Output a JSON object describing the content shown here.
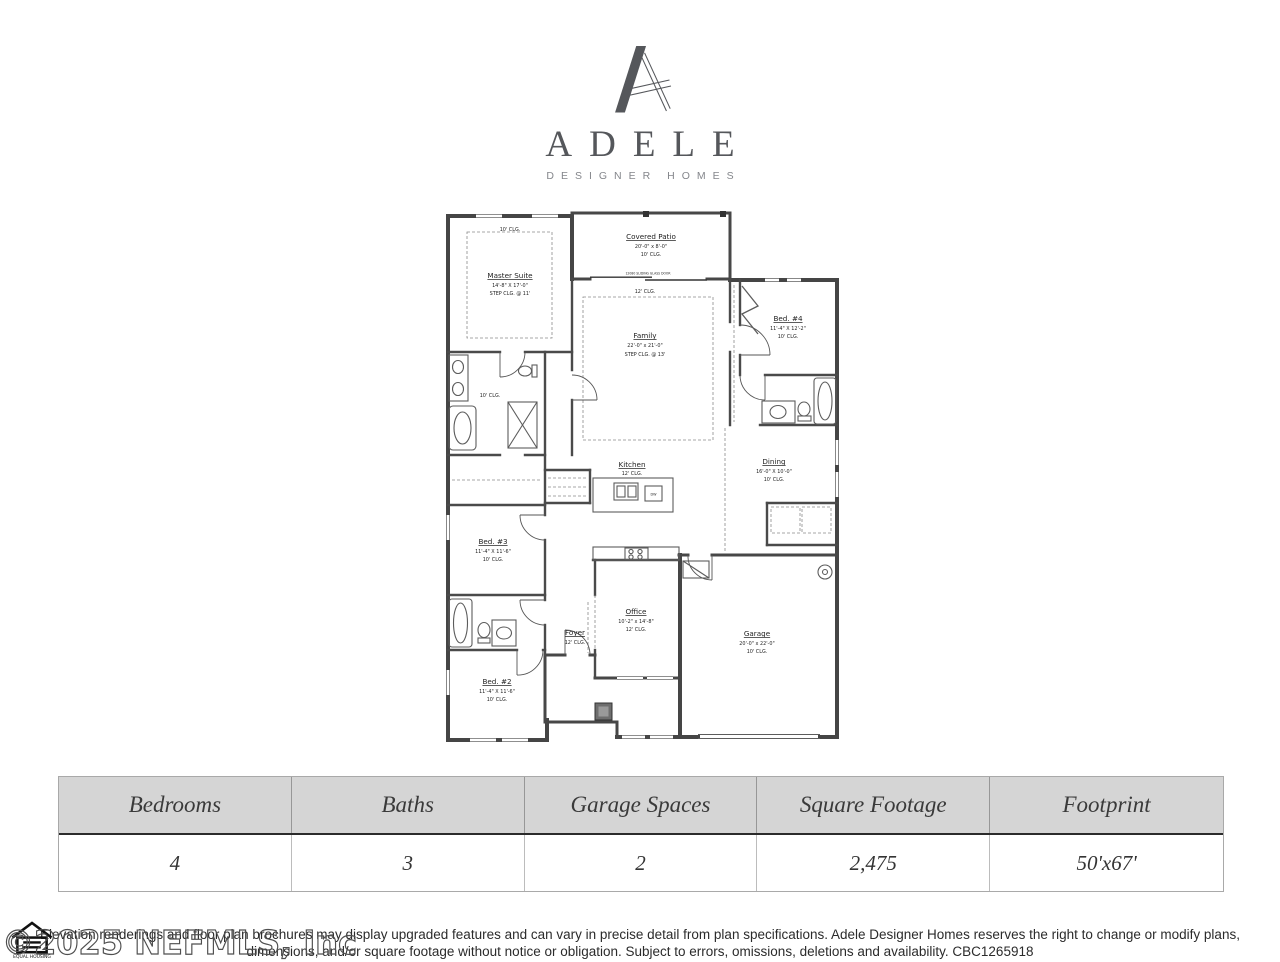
{
  "brand": {
    "name": "ADELE",
    "tagline": "DESIGNER HOMES"
  },
  "floor_plan": {
    "rooms": [
      {
        "name": "Master Suite",
        "dims": "14'-8\" X 17'-0\"",
        "ceiling": "STEP CLG. @ 11'"
      },
      {
        "name": "Covered Patio",
        "dims": "20'-0\" x 8'-0\"",
        "ceiling": "10' CLG."
      },
      {
        "name": "Family",
        "dims": "22'-0\" x 21'-0\"",
        "ceiling": "STEP CLG. @ 13'"
      },
      {
        "name": "Bed. #4",
        "dims": "11'-4\" X 12'-2\"",
        "ceiling": "10' CLG."
      },
      {
        "name": "Dining",
        "dims": "16'-0\" X 10'-0\"",
        "ceiling": "10' CLG."
      },
      {
        "name": "Kitchen",
        "dims": "",
        "ceiling": "12' CLG."
      },
      {
        "name": "Bed. #3",
        "dims": "11'-4\" X 11'-6\"",
        "ceiling": "10' CLG."
      },
      {
        "name": "Bed. #2",
        "dims": "11'-4\" X 11'-6\"",
        "ceiling": "10' CLG."
      },
      {
        "name": "Office",
        "dims": "10'-2\" x 14'-8\"",
        "ceiling": "12' CLG."
      },
      {
        "name": "Foyer",
        "dims": "",
        "ceiling": "12' CLG."
      },
      {
        "name": "Garage",
        "dims": "20'-0\" x 22'-0\"",
        "ceiling": "10' CLG."
      }
    ],
    "annotations": {
      "master_ceiling": "10' CLG.",
      "family_ceiling": "12' CLG.",
      "master_bath_ceiling": "10' CLG.",
      "patio_door": "12080 SLIDING GLASS DOOR",
      "dishwasher": "DW"
    }
  },
  "specs_table": {
    "columns": [
      "Bedrooms",
      "Baths",
      "Garage Spaces",
      "Square Footage",
      "Footprint"
    ],
    "values": [
      "4",
      "3",
      "2",
      "2,475",
      "50'x67'"
    ]
  },
  "disclaimer": {
    "line1": "Elevation renderings and floor plan brochures may display upgraded features and can vary in precise detail from plan specifications. Adele Designer Homes reserves the right to change or modify plans,",
    "line2": "dimensions, and/or square footage without notice or obligation. Subject to errors, omissions, deletions and availability. CBC1265918"
  },
  "watermark": "©2025 NEFMLS, Inc",
  "equal_housing": {
    "caption": "EQUAL HOUSING"
  }
}
